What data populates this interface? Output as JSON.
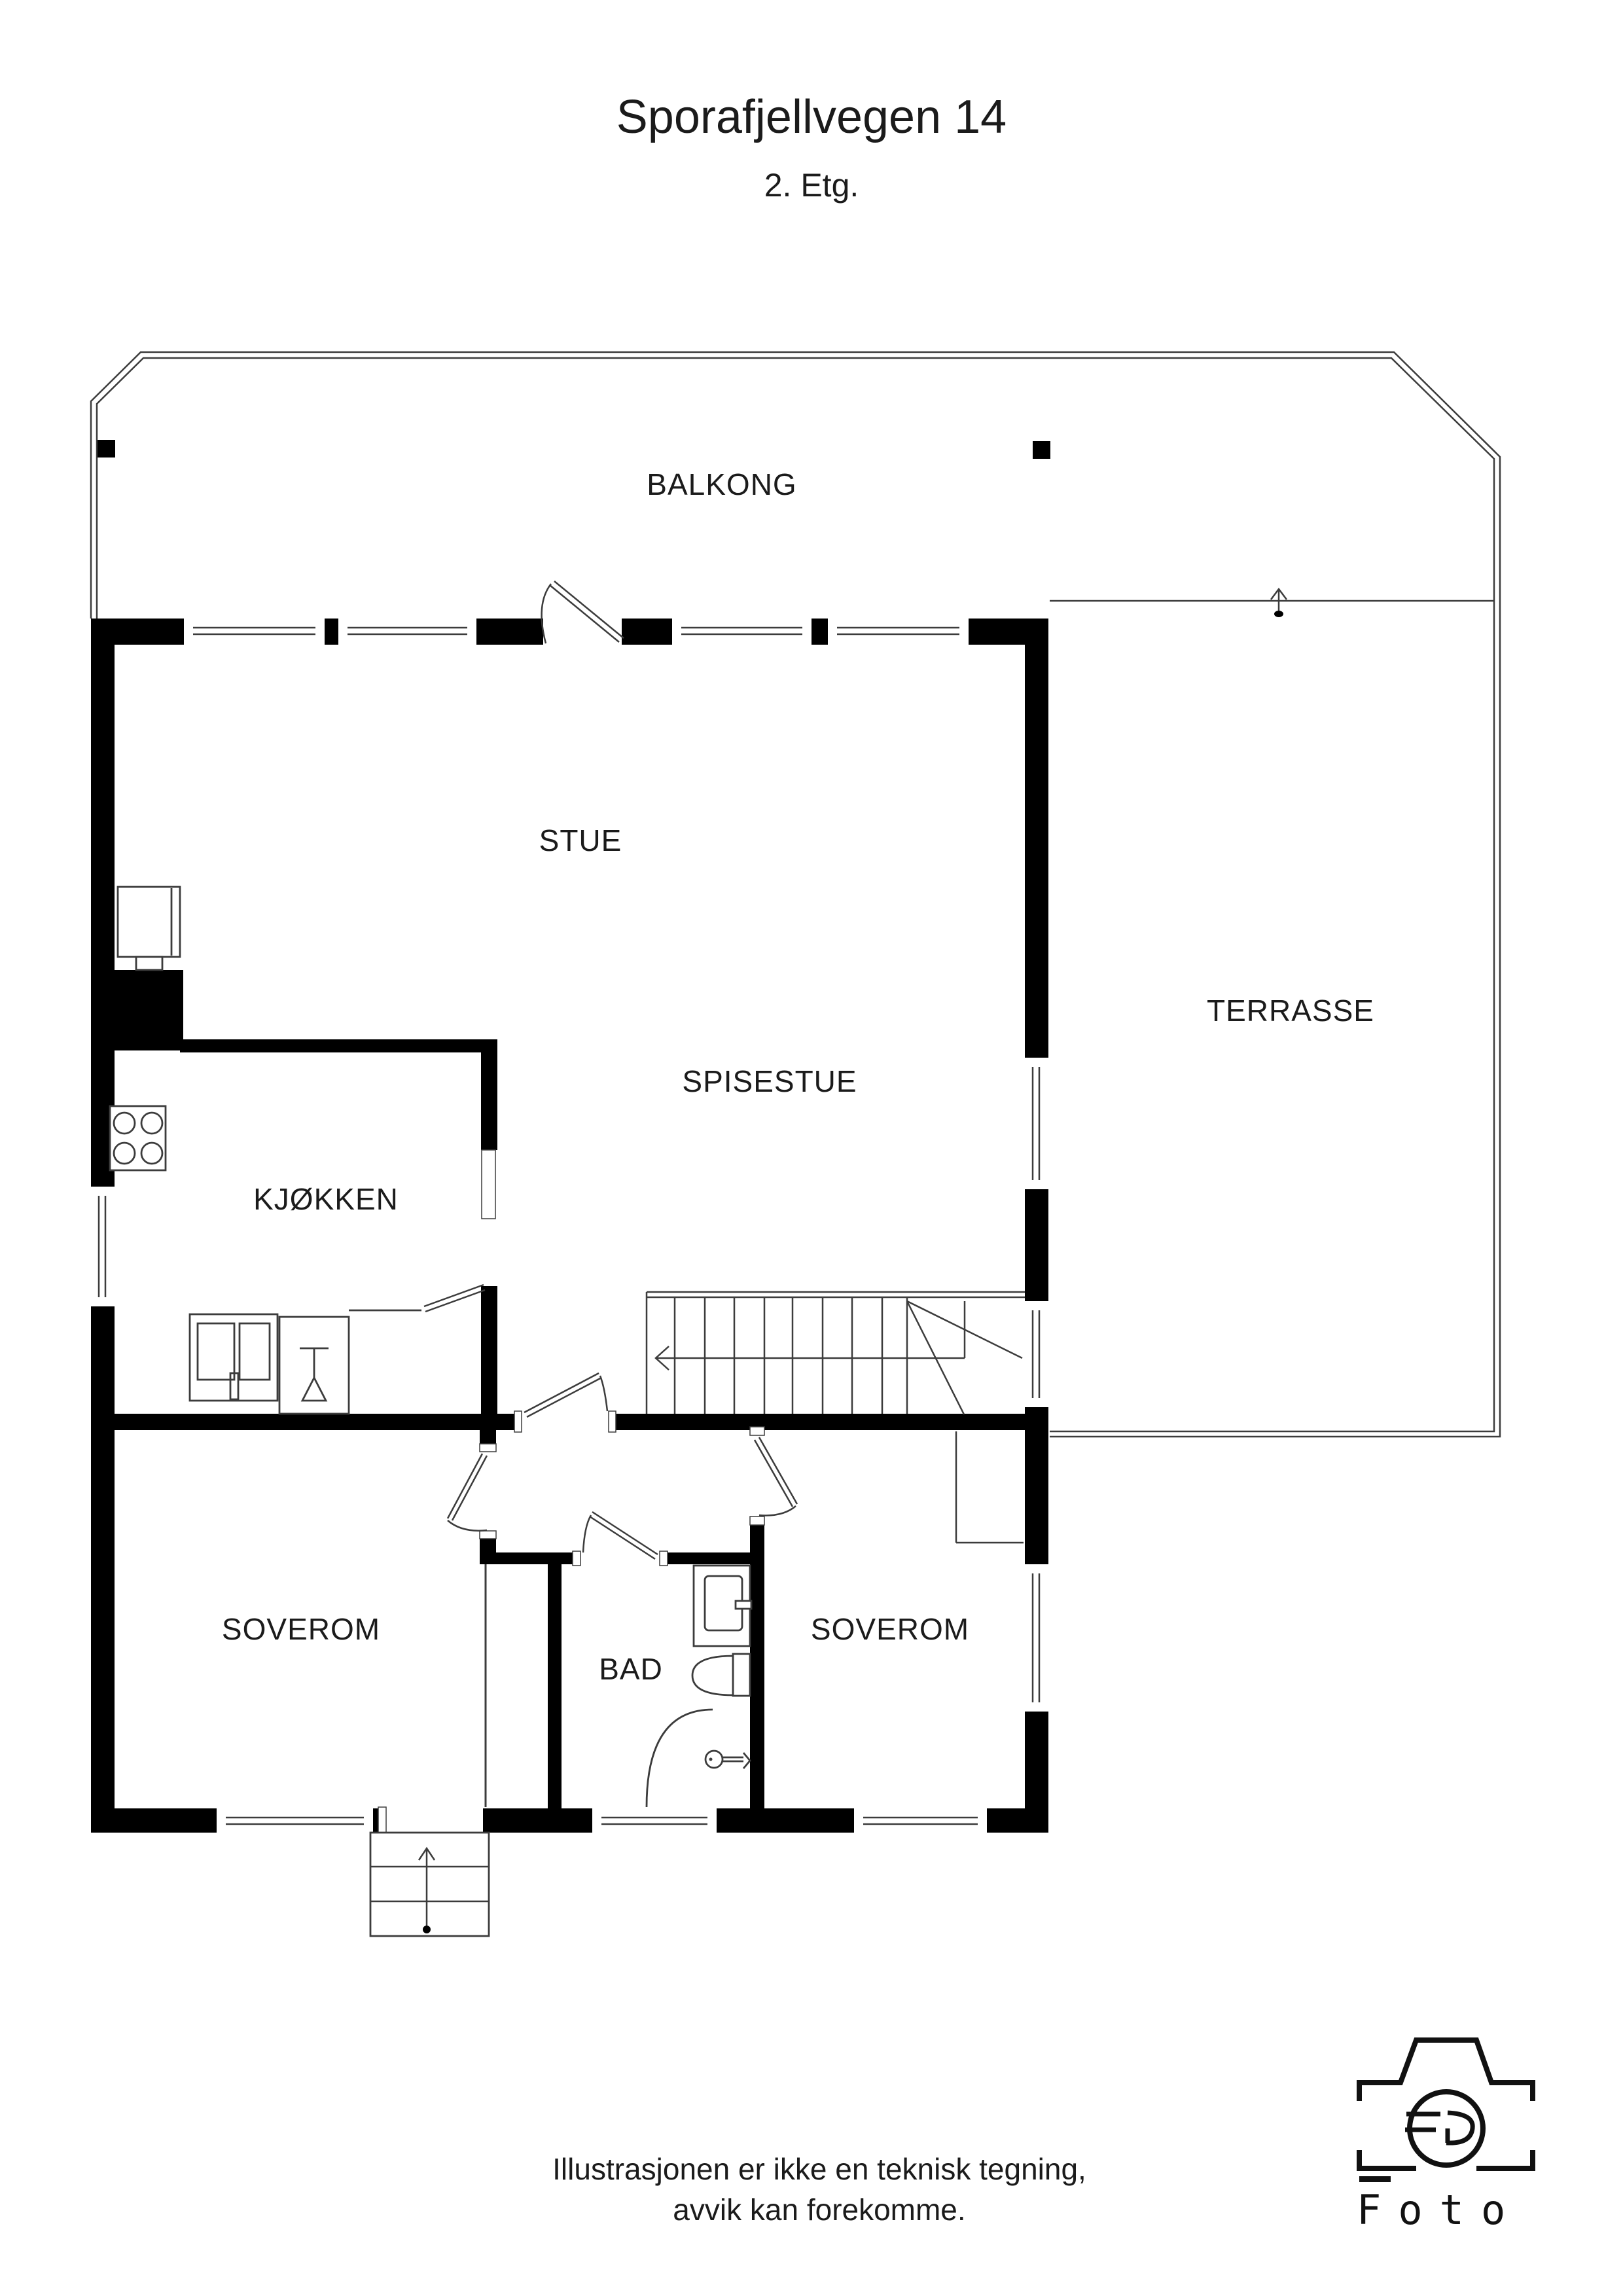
{
  "header": {
    "title": "Sporafjellvegen 14",
    "subtitle": "2. Etg."
  },
  "rooms": {
    "balkong": {
      "label": "BALKONG"
    },
    "stue": {
      "label": "STUE"
    },
    "spisestue": {
      "label": "SPISESTUE"
    },
    "terrasse": {
      "label": "TERRASSE"
    },
    "kjokken": {
      "label": "KJØKKEN"
    },
    "soverom_venstre": {
      "label": "SOVEROM"
    },
    "bad": {
      "label": "BAD"
    },
    "soverom_hoyre": {
      "label": "SOVEROM"
    }
  },
  "disclaimer": {
    "line1": "Illustrasjonen er ikke en teknisk tegning,",
    "line2": "avvik kan forekomme."
  },
  "logo": {
    "wordmark": "Foto"
  },
  "colors": {
    "wall": "#000000",
    "thin_line": "#3c3c3c",
    "text": "#1b1b1b",
    "background": "#ffffff"
  }
}
